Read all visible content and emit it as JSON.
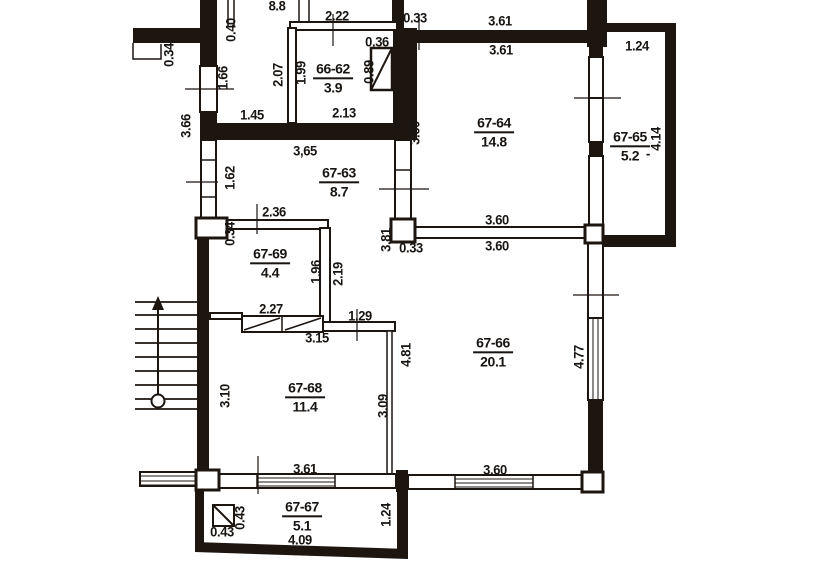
{
  "plan_type": "apartment-floor-plan",
  "rooms": [
    {
      "number": "66-62",
      "area": "3.9"
    },
    {
      "number": "67-63",
      "area": "8.7"
    },
    {
      "number": "67-64",
      "area": "14.8"
    },
    {
      "number": "67-65",
      "area": "5.2"
    },
    {
      "number": "67-66",
      "area": "20.1"
    },
    {
      "number": "67-67",
      "area": "5.1"
    },
    {
      "number": "67-68",
      "area": "11.4"
    },
    {
      "number": "67-69",
      "area": "4.4"
    }
  ],
  "dims_h": [
    "8.8",
    "2.22",
    "0.33",
    "3.61",
    "3.61",
    "1.24",
    "0.36",
    "1.45",
    "2.13",
    "3,65",
    "2.36",
    "3.60",
    "3.60",
    "0.33",
    "2.27",
    "1.29",
    "3.15",
    "3.61",
    "3.60",
    "4.09",
    "0.43",
    "-"
  ],
  "dims_v": [
    "0.34",
    "0.40",
    "1.66",
    "3.66",
    "2.07",
    "1.99",
    "0.89",
    "3.60",
    "1.62",
    "0.34",
    "3.81",
    "1.96",
    "2.19",
    "4.14",
    "4.77",
    "3.10",
    "3.09",
    "4.81",
    "1.24",
    "0.43"
  ],
  "symbols": {
    "stairs": "stairs-with-up-arrow",
    "shaft_top": "ventilation-shaft-diagonal",
    "shaft_bottom": "ventilation-shaft-diagonal",
    "closet": "built-in-closet-hatch",
    "windows": "double-line-window"
  },
  "colors": {
    "wall": "#1c1510",
    "paper": "#ffffff",
    "text": "#181411"
  }
}
